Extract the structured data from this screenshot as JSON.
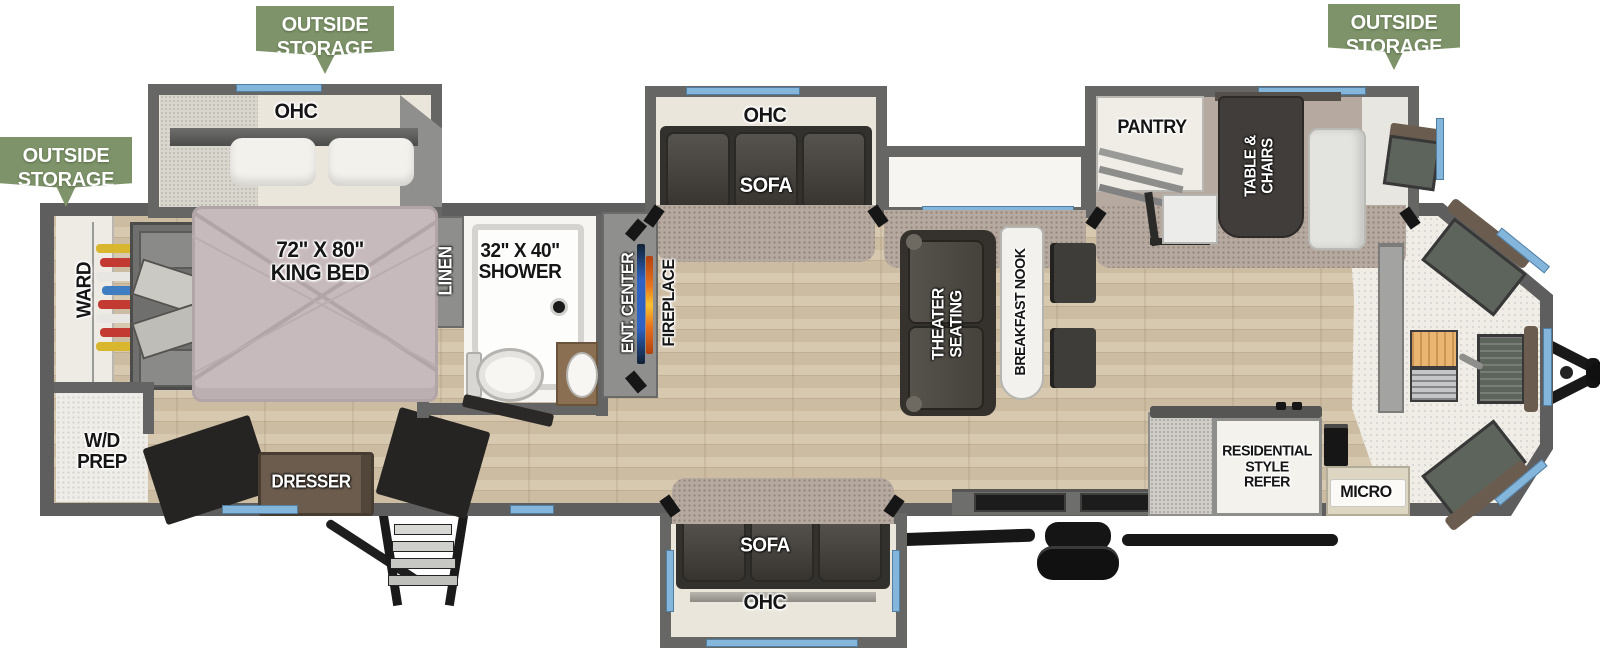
{
  "banners": [
    {
      "text": "OUTSIDE\nSTORAGE"
    },
    {
      "text": "OUTSIDE\nSTORAGE"
    },
    {
      "text": "OUTSIDE\nSTORAGE"
    }
  ],
  "bedroom": {
    "ohc": "OHC",
    "king_bed": "72\" X 80\"\nKING BED",
    "ward": "WARD",
    "wd_prep": "W/D\nPREP",
    "dresser": "DRESSER"
  },
  "bathroom": {
    "linen": "LINEN",
    "shower": "32\" X 40\"\nSHOWER"
  },
  "living": {
    "ent_center": "ENT. CENTER",
    "fireplace": "FIREPLACE",
    "ohc_sofa_top": "OHC",
    "sofa_top": "SOFA",
    "theater": "THEATER\nSEATING",
    "breakfast_nook": "BREAKFAST NOOK",
    "sofa_bottom": "SOFA",
    "ohc_sofa_bottom": "OHC"
  },
  "kitchen": {
    "pantry": "PANTRY",
    "table_chairs": "TABLE &\nCHAIRS",
    "refer": "RESIDENTIAL\nSTYLE\nREFER",
    "micro": "MICRO"
  },
  "colors": {
    "banner_green": "#7e9369",
    "wall_gray": "#5e5e5e",
    "window_blue": "#84b6dc",
    "wood_floor": "#ccbca2",
    "carpet": "#b5a9a0",
    "cap_floor": "#f0ede7",
    "sofa_dark": "#3a3835",
    "bed_mauve": "#c7babd",
    "tv_blue": "#2f62c2",
    "fireplace_orange": "#e8731e"
  }
}
